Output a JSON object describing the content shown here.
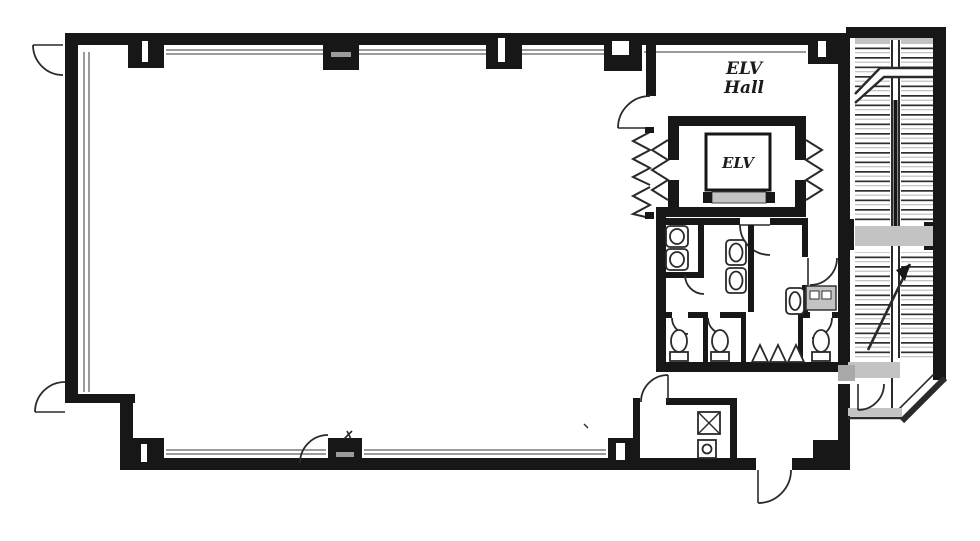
{
  "labels": {
    "elevator_hall_line1": "ELV",
    "elevator_hall_line2": "Hall",
    "elevator_car": "ELV"
  },
  "colors": {
    "wall": "#171717",
    "line": "#2a2a2a",
    "window": "#9b9b9b",
    "hatch": "#c3c3c3",
    "hatchdark": "#a9a9a9",
    "text": "#1b1b1b",
    "background": "#ffffff"
  }
}
